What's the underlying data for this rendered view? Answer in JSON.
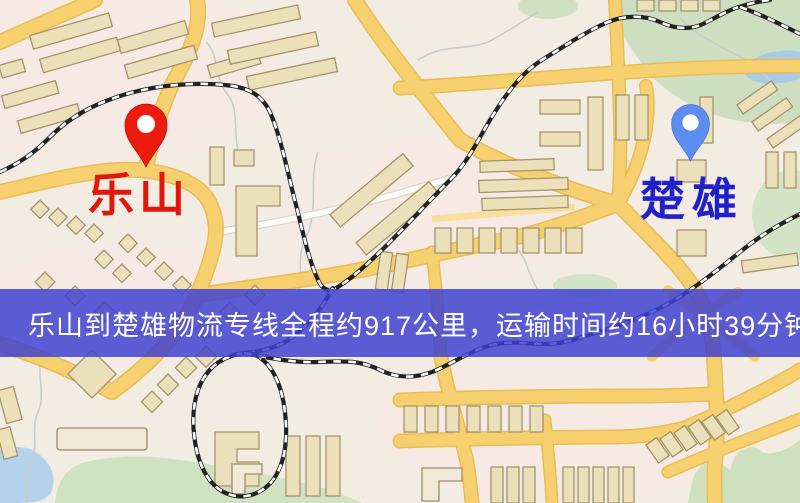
{
  "map_overlay": {
    "origin": {
      "name": "乐山"
    },
    "destination": {
      "name": "楚雄"
    },
    "banner": {
      "text": "乐山到楚雄物流专线全程约917公里，运输时间约16小时39分钟."
    },
    "route_info": {
      "distance_km": "917",
      "duration_hours": "16",
      "duration_minutes": "39"
    },
    "colors": {
      "origin_pin": "#ed1b0d",
      "origin_label": "#e1170a",
      "destination_pin": "#5c8df1",
      "destination_label": "#2121cb",
      "banner_bg": "#3e40d0",
      "banner_text": "#ffffff",
      "road": "#f6cf6e",
      "water": "#aecdea",
      "park": "#cddfc0",
      "railway": "#222222"
    }
  }
}
